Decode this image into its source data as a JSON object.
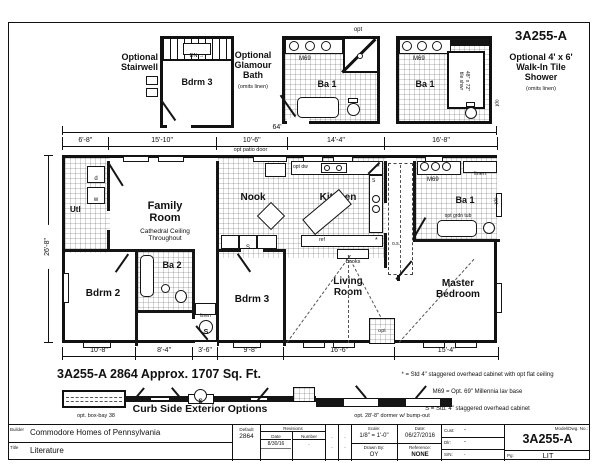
{
  "model_no": "3A255-A",
  "insets": {
    "stairwell_label": "Optional\nStairwell",
    "stairwell_room": "Bdrm 3",
    "dn": "DN →",
    "glamour_label": "Optional\nGlamour\nBath",
    "glamour_note": "(omits linen)",
    "glamour_room": "Ba 1",
    "tileshower_room": "Ba 1",
    "tileshower_size": "48\" x 72\"\ntile shwr",
    "walkin_label": "Optional 4' x 6'\nWalk-In Tile\nShower",
    "walkin_note": "(omits linen)",
    "m69": "M69",
    "opt": "opt"
  },
  "dims": {
    "overall": "64'",
    "depth": "26'-8\"",
    "top": [
      "6'-8\"",
      "15'-10\"",
      "10'-6\"",
      "14'-4\"",
      "16'-8\""
    ],
    "patio_note": "opt patio door",
    "bottom": [
      "10'-8\"",
      "8'-4\"",
      "3'-6\"",
      "9'-8\"",
      "16'-6\"",
      "15'-4\""
    ]
  },
  "rooms": {
    "utility": "Utl",
    "family": "Family\nRoom",
    "family_note": "Cathedral Ceiling\nThroughout",
    "nook": "Nook",
    "kitchen": "Kitchen",
    "bath1": "Ba 1",
    "bdrm2": "Bdrm 2",
    "bath2": "Ba 2",
    "bdrm3": "Bdrm 3",
    "living": "Living\nRoom",
    "master": "Master\nBedroom"
  },
  "ann": {
    "opt_dw": "opt dw",
    "ref": "ref",
    "books": "books",
    "os": "o.s.",
    "m69": "M69",
    "linen": "linen",
    "opt": "opt",
    "grdn_tub": "opt grdn tub",
    "s": "S",
    "w": "w",
    "d": "d",
    "star": "*"
  },
  "legend": [
    "* = Std 4\" staggered overhead cabinet with opt flat ceiling",
    "M69 = Opt. 69\" Millennia lav base",
    "S = Std. 4\" staggered overhead cabinet"
  ],
  "plan_title": "3A255-A 2864  Approx. 1707 Sq. Ft.",
  "curbside": {
    "title": "Curb Side Exterior Options",
    "boxbay": "opt. box-bay 38",
    "dormer": "opt. 28'-8\" dormer w/ bump-out"
  },
  "titleblock": {
    "builder_label": "Builder",
    "builder": "Commodore Homes of Pennsylvania",
    "title_label": "Title",
    "title": "Literature",
    "default_label": "Default",
    "default_value": "2864",
    "revisions": "Revisions",
    "rev_date_label": "Date",
    "rev_number_label": "Number",
    "rev_date": "8/30/16",
    "dot": ".",
    "scale_label": "Scale:",
    "scale": "1/8\" = 1'-0\"",
    "date_label": "Date:",
    "date": "06/27/2016",
    "drawn_label": "Drawn By:",
    "drawn": "OY",
    "ref_label": "Reference:",
    "ref": "NONE",
    "cust_label": "Cust:",
    "cust": "-",
    "dlr_label": "Dlr:",
    "dlr": "-",
    "sn_label": "S/N:",
    "sn": ".",
    "model_label": "Model/Dwg. No.:",
    "model": "3A255-A",
    "pg_label": "Pg:",
    "pg": "LIT"
  }
}
